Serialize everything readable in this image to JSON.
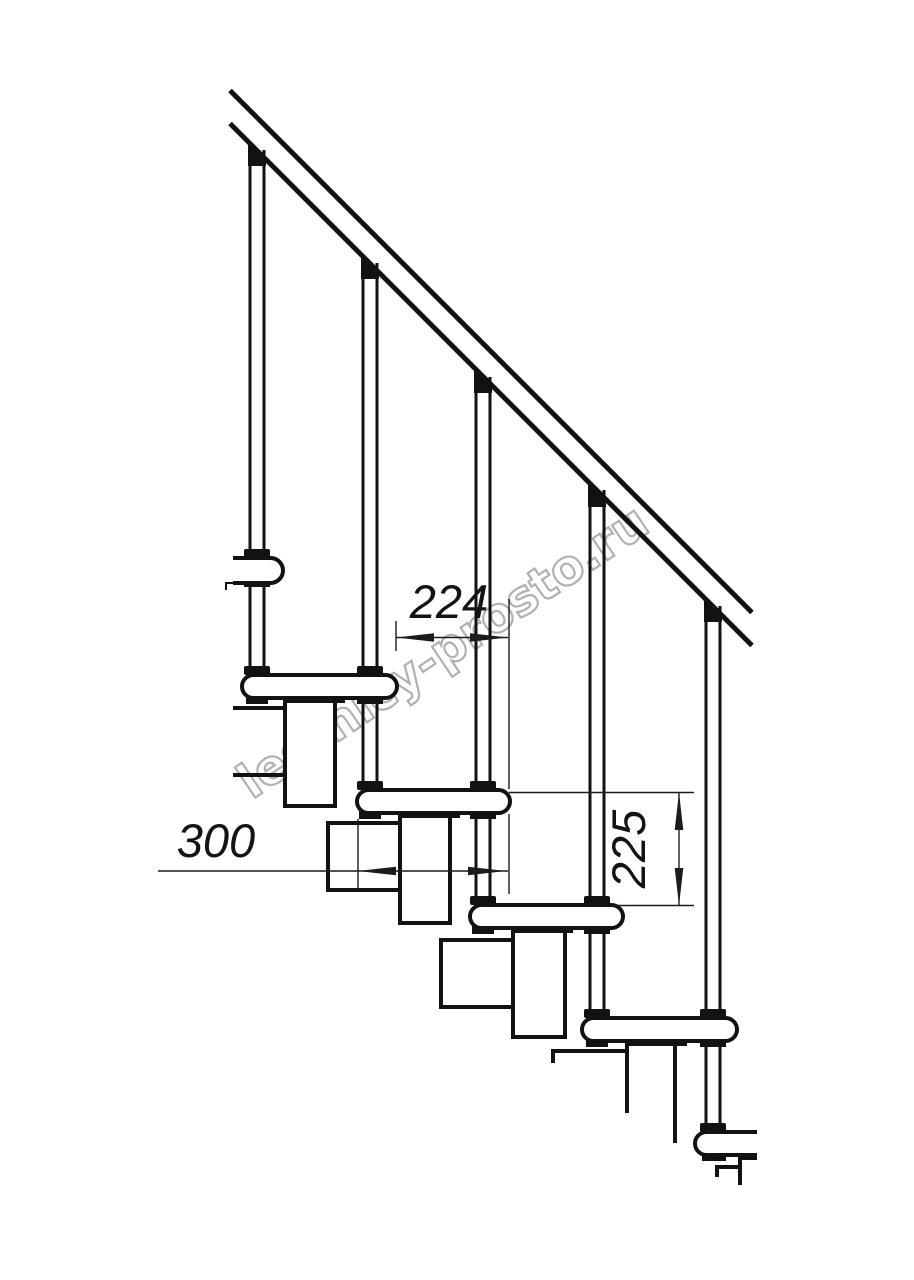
{
  "page": {
    "background_color": "#ffffff"
  },
  "drawing": {
    "watermark_text": "lestnicy-prosto.ru",
    "line_color": "#121212",
    "thin_line_color": "#1c1c1c",
    "watermark_outline_color": "#b1b1b1",
    "watermark_fill_color": "rgba(255,255,255,0.55)",
    "dimensions": {
      "baluster_spacing": {
        "value": "224"
      },
      "tread_length": {
        "value": "300"
      },
      "rise_height": {
        "value": "225"
      }
    },
    "element_counts": {
      "balusters_visible": "5",
      "treads_visible": "6"
    }
  }
}
